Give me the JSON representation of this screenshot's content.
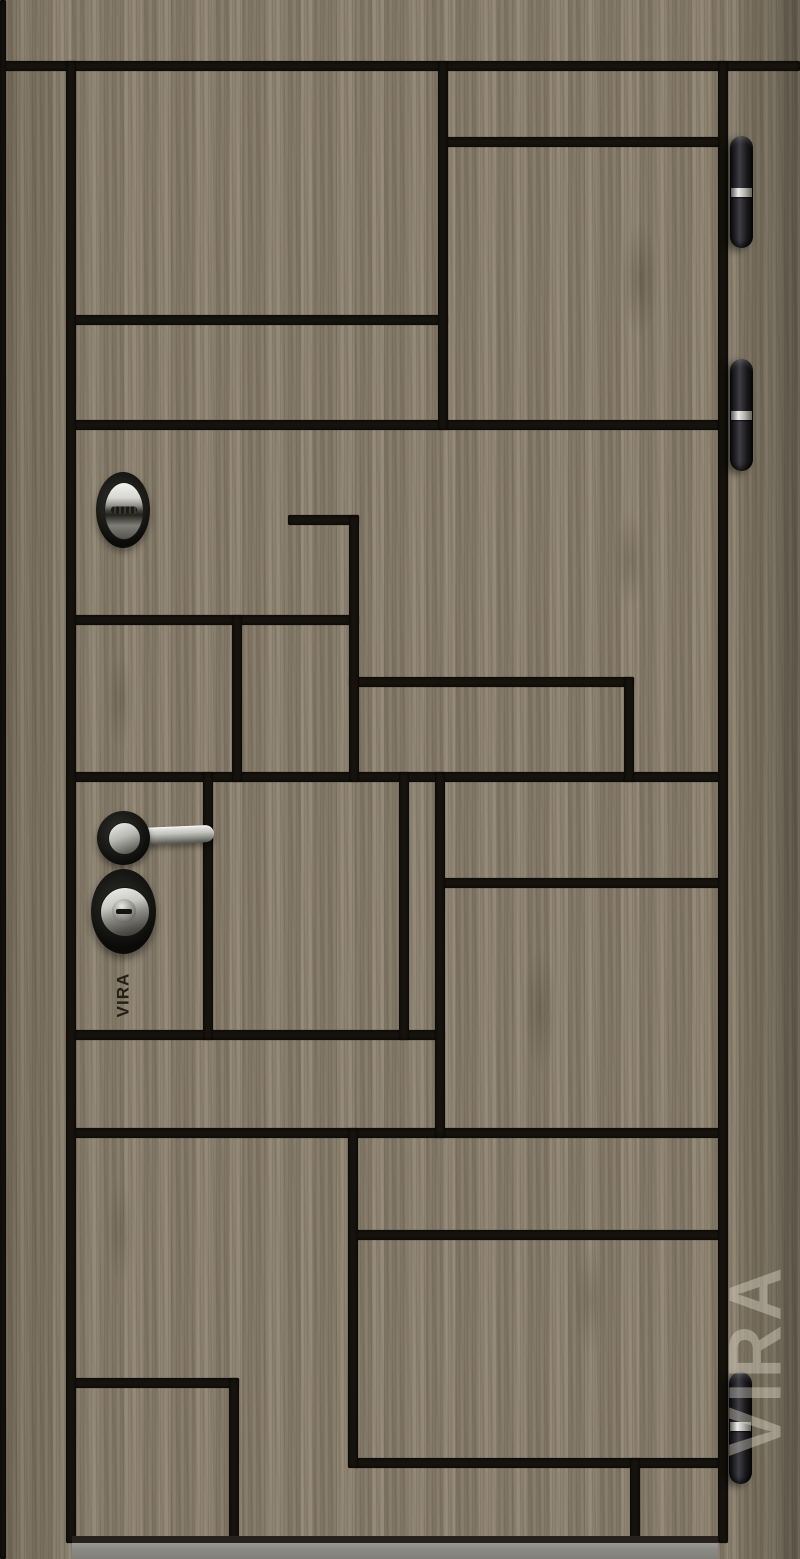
{
  "image": {
    "subject": "entrance door product photo",
    "finish": "taupe wood laminate with black milled grooves"
  },
  "brand": {
    "stamp_text": "VIRA",
    "watermark_text": "VIRA"
  },
  "palette": {
    "wood_base": "#8e8371",
    "groove_black": "#17130e",
    "hinge_black": "#1a1a1e",
    "chrome": "#c9c9c4",
    "floor_grey": "#8b8a85"
  },
  "door": {
    "grooves": [
      {
        "x": 0,
        "y": 61,
        "w": 800,
        "h": 10
      },
      {
        "x": 443,
        "y": 137,
        "w": 280,
        "h": 10
      },
      {
        "x": 71,
        "y": 315,
        "w": 377,
        "h": 10
      },
      {
        "x": 71,
        "y": 420,
        "w": 652,
        "h": 10
      },
      {
        "x": 288,
        "y": 515,
        "w": 71,
        "h": 10
      },
      {
        "x": 71,
        "y": 615,
        "w": 288,
        "h": 10
      },
      {
        "x": 349,
        "y": 677,
        "w": 285,
        "h": 10
      },
      {
        "x": 71,
        "y": 772,
        "w": 652,
        "h": 10
      },
      {
        "x": 440,
        "y": 878,
        "w": 283,
        "h": 10
      },
      {
        "x": 71,
        "y": 1030,
        "w": 374,
        "h": 10
      },
      {
        "x": 71,
        "y": 1128,
        "w": 652,
        "h": 10
      },
      {
        "x": 353,
        "y": 1230,
        "w": 370,
        "h": 10
      },
      {
        "x": 71,
        "y": 1378,
        "w": 168,
        "h": 10
      },
      {
        "x": 353,
        "y": 1458,
        "w": 370,
        "h": 10
      },
      {
        "x": 0,
        "y": 0,
        "w": 6,
        "h": 1559
      },
      {
        "x": 66,
        "y": 61,
        "w": 10,
        "h": 1482
      },
      {
        "x": 718,
        "y": 61,
        "w": 10,
        "h": 1482
      },
      {
        "x": 438,
        "y": 61,
        "w": 10,
        "h": 369
      },
      {
        "x": 349,
        "y": 515,
        "w": 10,
        "h": 267
      },
      {
        "x": 232,
        "y": 615,
        "w": 10,
        "h": 167
      },
      {
        "x": 624,
        "y": 677,
        "w": 10,
        "h": 105
      },
      {
        "x": 203,
        "y": 772,
        "w": 10,
        "h": 268
      },
      {
        "x": 399,
        "y": 772,
        "w": 10,
        "h": 268
      },
      {
        "x": 435,
        "y": 772,
        "w": 10,
        "h": 366
      },
      {
        "x": 348,
        "y": 1128,
        "w": 10,
        "h": 340
      },
      {
        "x": 229,
        "y": 1378,
        "w": 10,
        "h": 165
      },
      {
        "x": 630,
        "y": 1458,
        "w": 10,
        "h": 85
      }
    ],
    "hinges": [
      {
        "x": 730,
        "y": 136,
        "band": 52
      },
      {
        "x": 730,
        "y": 359,
        "band": 52
      },
      {
        "x": 729,
        "y": 1372,
        "band": 50
      }
    ]
  }
}
